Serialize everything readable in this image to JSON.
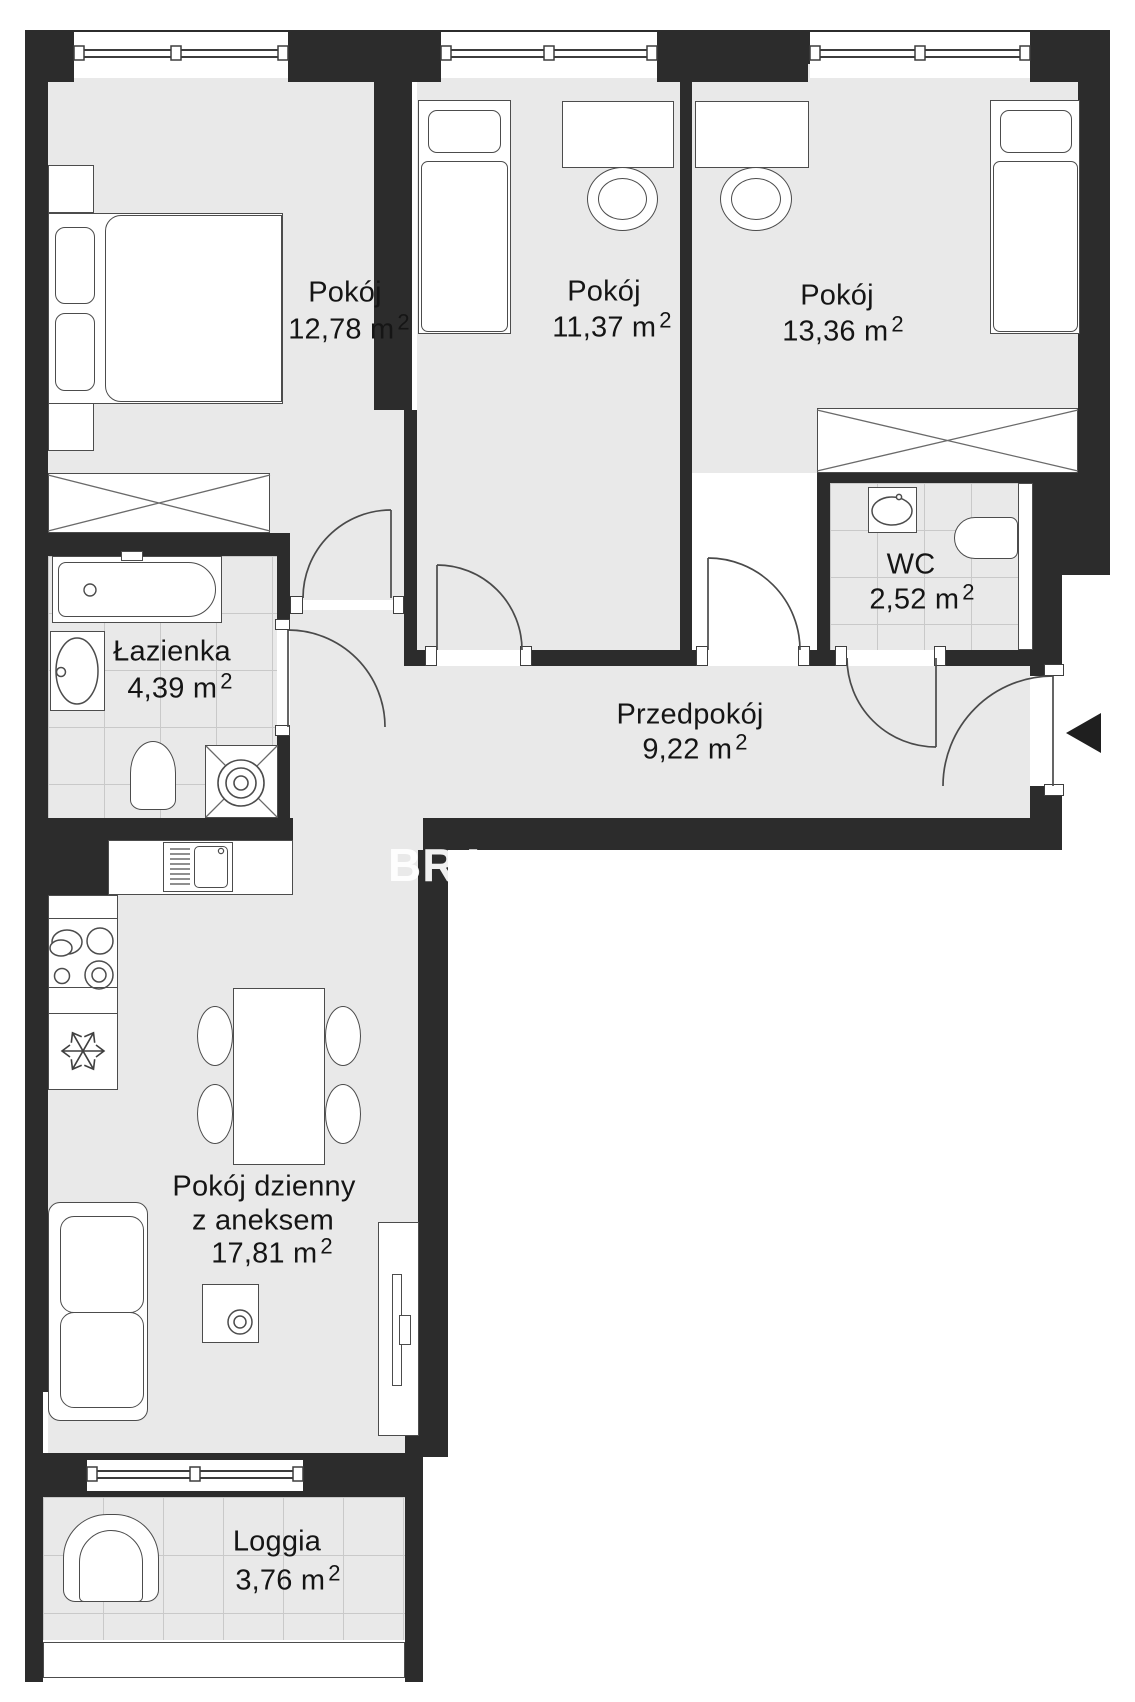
{
  "page": {
    "type": "apartment-floor-plan",
    "watermark": "BRA"
  },
  "colors": {
    "wall": "#2c2c2c",
    "floor": "#e9e9e9",
    "tile_line": "#c9c9c9",
    "furniture_outline": "#4c4c4c",
    "text": "#151515",
    "watermark": "#ffffff",
    "entry_arrow": "#1f1f1f"
  },
  "rooms": [
    {
      "name": "Pokój",
      "area": "12,78 m",
      "sup": "2"
    },
    {
      "name": "Pokój",
      "area": "11,37 m",
      "sup": "2"
    },
    {
      "name": "Pokój",
      "area": "13,36 m",
      "sup": "2"
    },
    {
      "name": "WC",
      "area": "2,52 m",
      "sup": "2"
    },
    {
      "name": "Łazienka",
      "area": "4,39 m",
      "sup": "2"
    },
    {
      "name": "Przedpokój",
      "area": "9,22 m",
      "sup": "2"
    },
    {
      "name": "Pokój dzienny",
      "name2": "z aneksem",
      "area": "17,81 m",
      "sup": "2"
    },
    {
      "name": "Loggia",
      "area": "3,76 m",
      "sup": "2"
    }
  ]
}
